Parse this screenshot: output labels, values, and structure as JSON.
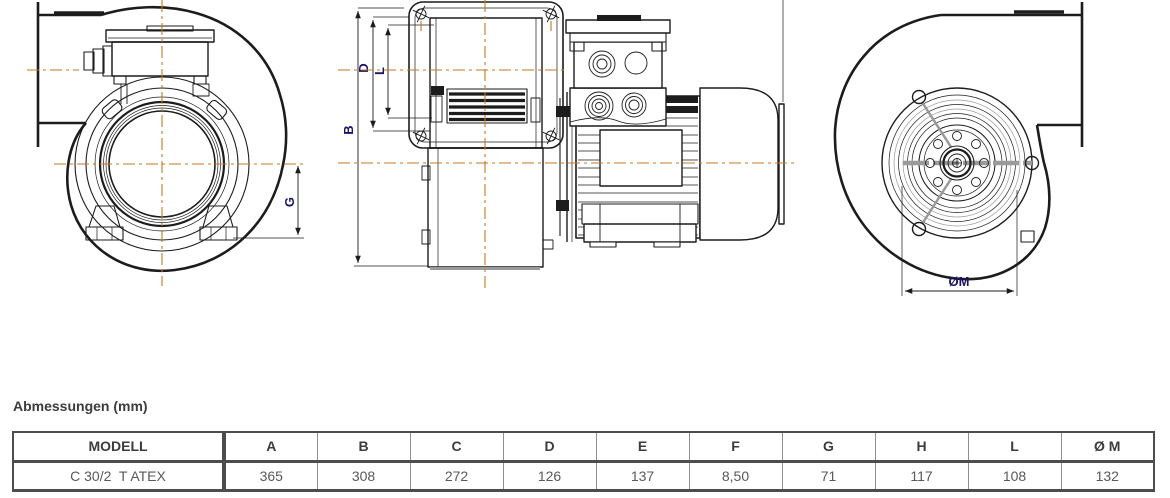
{
  "section_title": "Abmessungen (mm)",
  "drawing": {
    "dim_labels": {
      "g": "G",
      "b": "B",
      "d": "D",
      "l": "L",
      "om": "ØM"
    },
    "colors": {
      "centerline": "#c4791f",
      "dim_label": "#1b1464",
      "line": "#1c1c1c"
    }
  },
  "table": {
    "headers": [
      "MODELL",
      "A",
      "B",
      "C",
      "D",
      "E",
      "F",
      "G",
      "H",
      "L",
      "Ø M"
    ],
    "rows": [
      {
        "model": "C 30/2  T ATEX",
        "values": [
          "365",
          "308",
          "272",
          "126",
          "137",
          "8,50",
          "71",
          "117",
          "108",
          "132"
        ]
      }
    ]
  }
}
